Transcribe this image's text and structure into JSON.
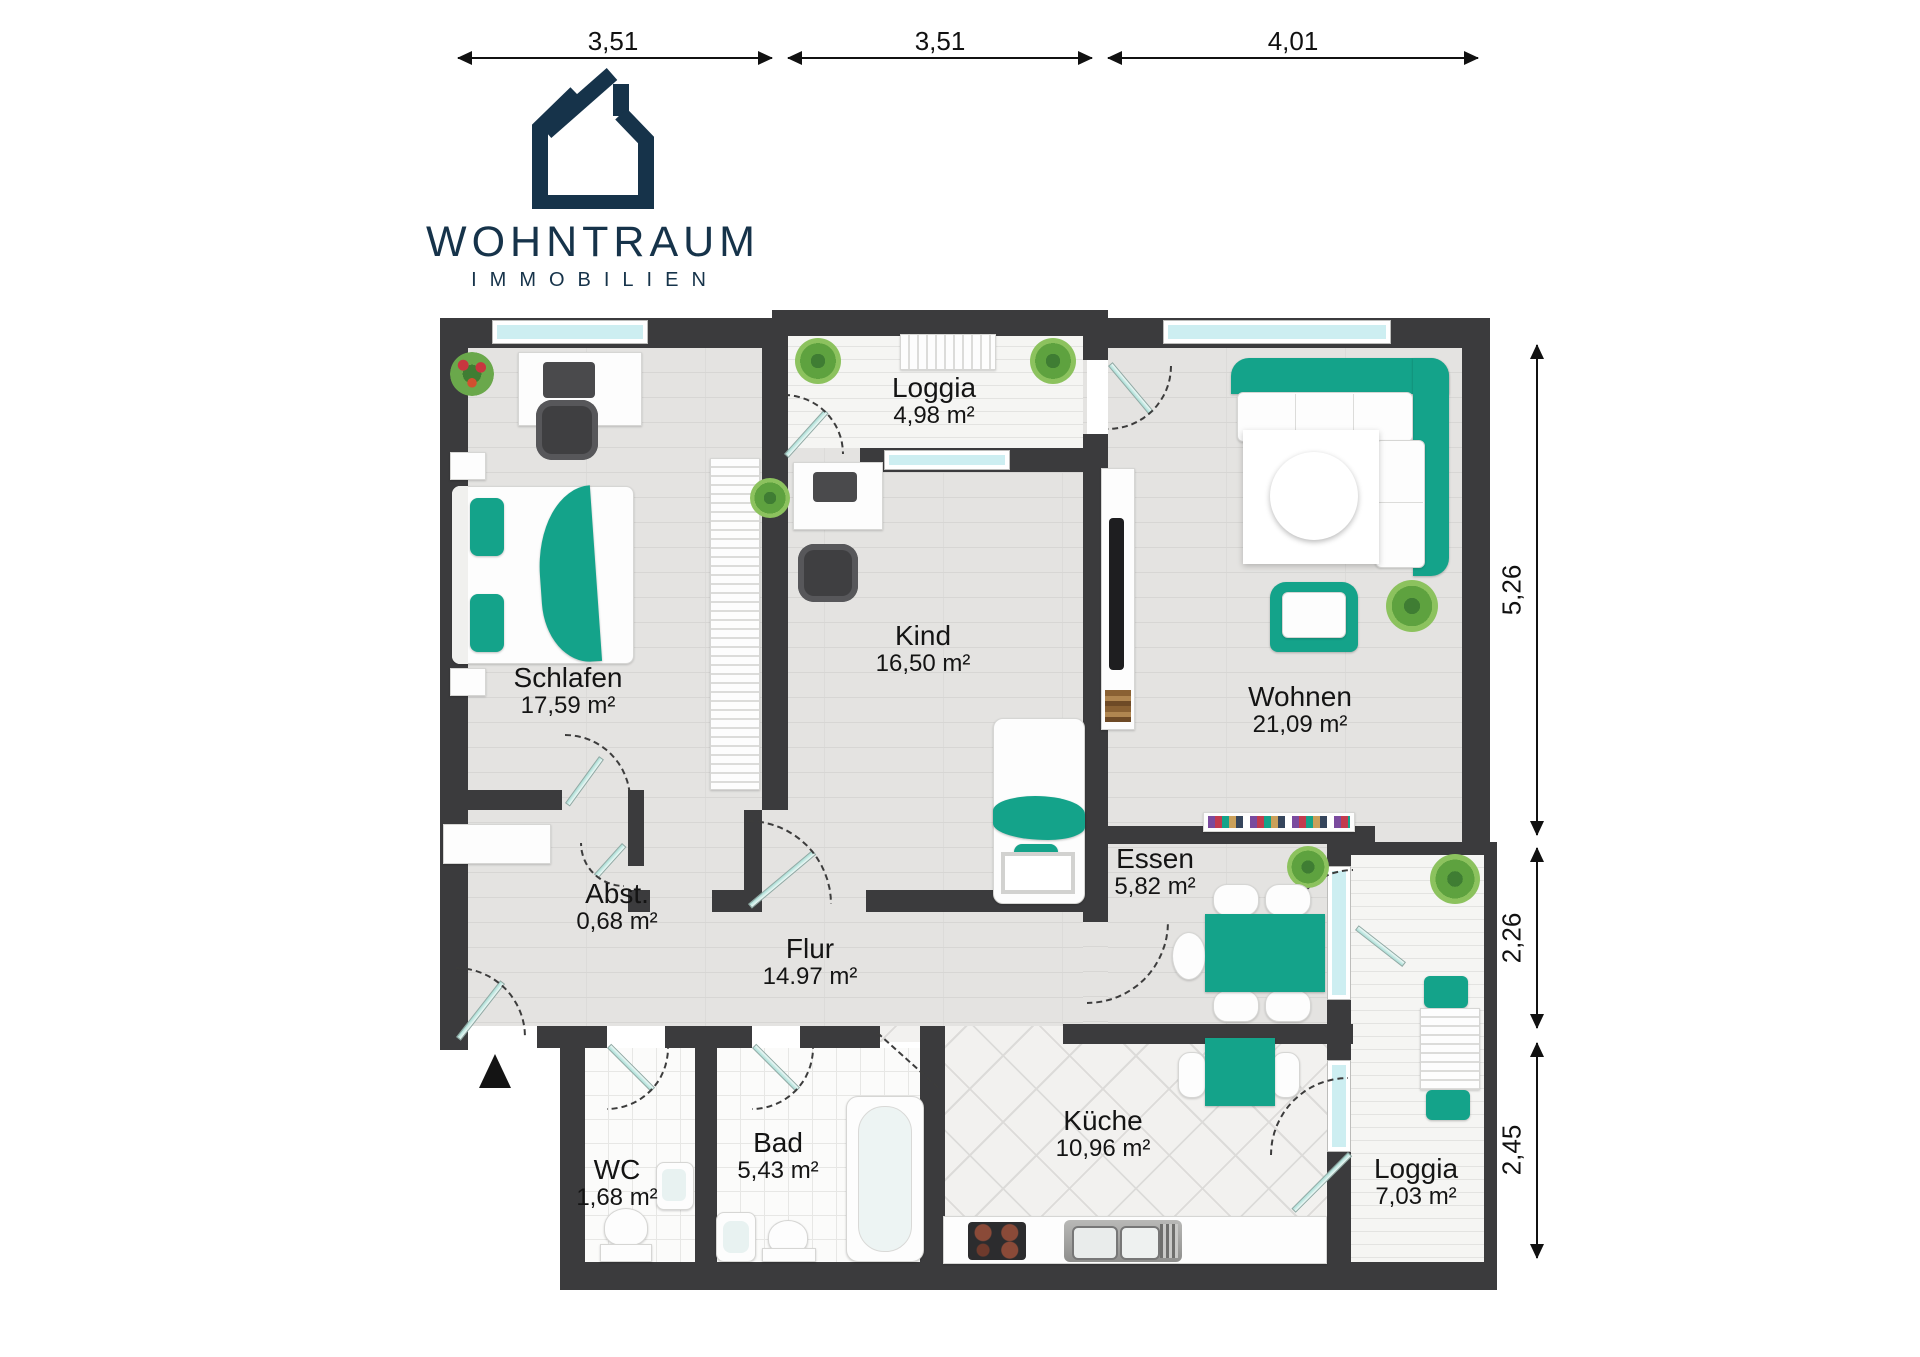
{
  "logo": {
    "title": "WOHNTRAUM",
    "subtitle": "IMMOBILIEN"
  },
  "dimensions": {
    "top": [
      "3,51",
      "3,51",
      "4,01"
    ],
    "right": [
      "5,26",
      "2,26",
      "2,45"
    ]
  },
  "rooms": {
    "schlafen": {
      "name": "Schlafen",
      "area": "17,59 m²"
    },
    "kind": {
      "name": "Kind",
      "area": "16,50 m²"
    },
    "wohnen": {
      "name": "Wohnen",
      "area": "21,09 m²"
    },
    "loggia_top": {
      "name": "Loggia",
      "area": "4,98 m²"
    },
    "essen": {
      "name": "Essen",
      "area": "5,82 m²"
    },
    "abstellraum": {
      "name": "Abst.",
      "area": "0,68 m²"
    },
    "flur": {
      "name": "Flur",
      "area": "14.97 m²"
    },
    "wc": {
      "name": "WC",
      "area": "1,68 m²"
    },
    "bad": {
      "name": "Bad",
      "area": "5,43 m²"
    },
    "kueche": {
      "name": "Küche",
      "area": "10,96 m²"
    },
    "loggia_right": {
      "name": "Loggia",
      "area": "7,03 m²"
    }
  },
  "colors": {
    "wall": "#3b3b3d",
    "accent_teal": "#14a38a",
    "logo_navy": "#16334a",
    "window_glass": "#cdeef1"
  }
}
